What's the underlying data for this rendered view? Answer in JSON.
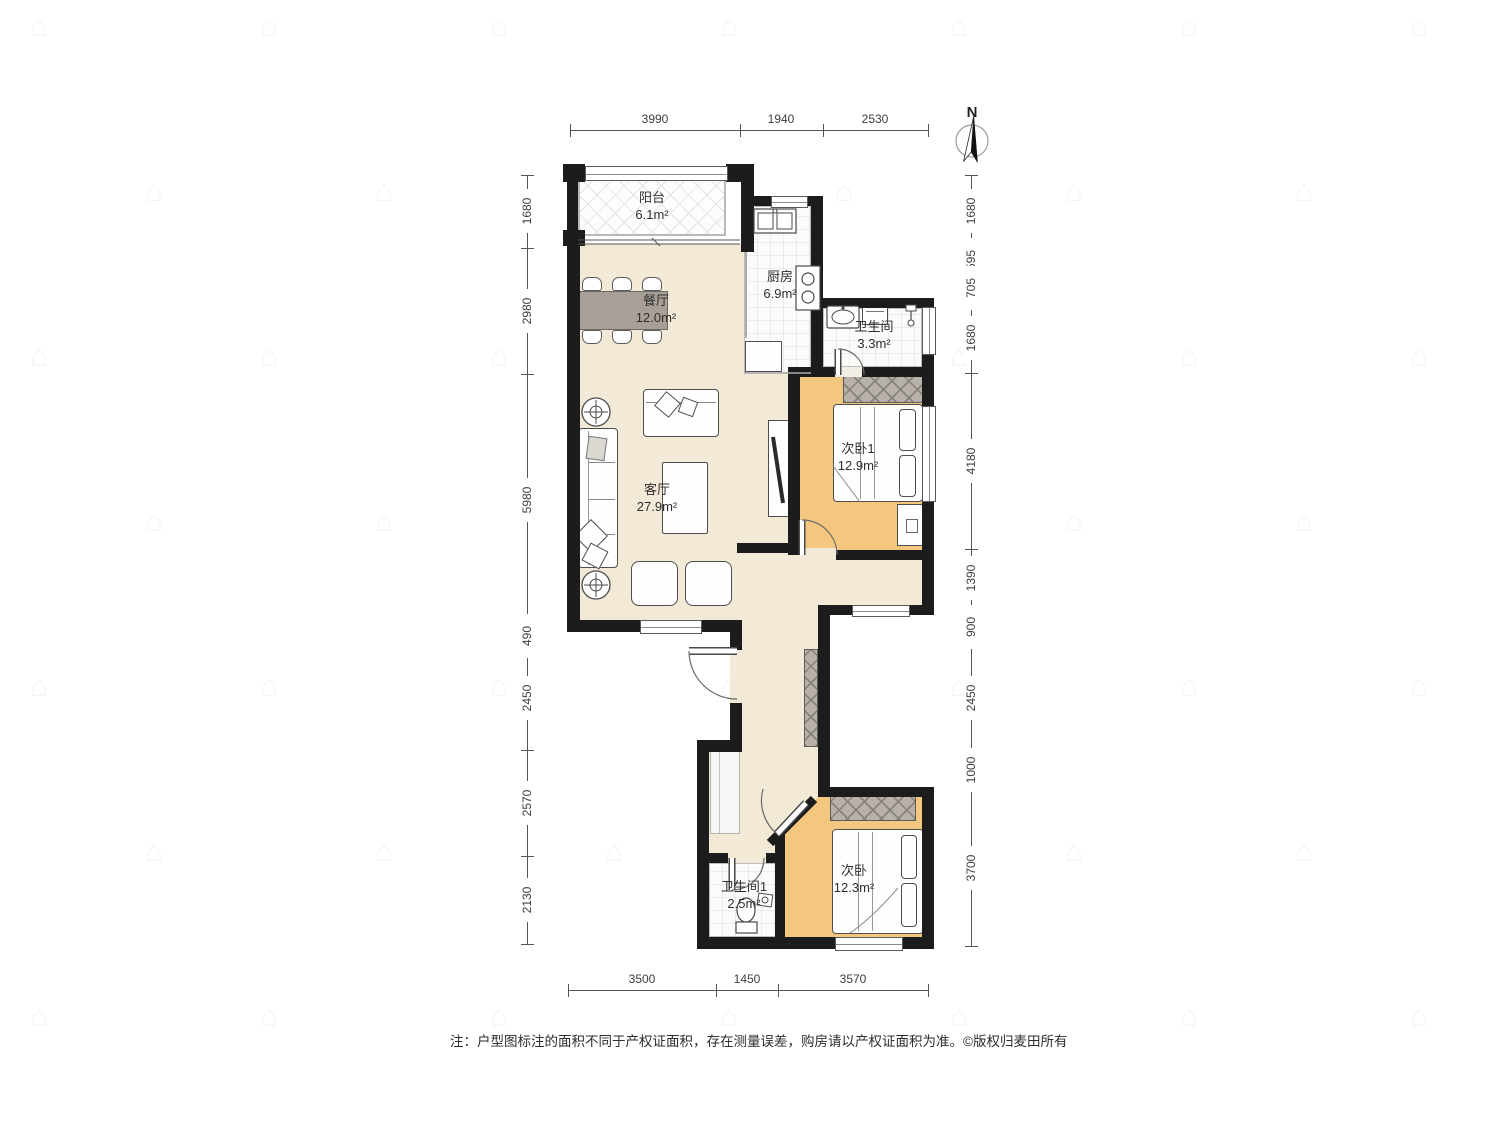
{
  "north_label": "N",
  "rooms": {
    "balcony": {
      "name": "阳台",
      "area": "6.1m²"
    },
    "kitchen": {
      "name": "厨房",
      "area": "6.9m²"
    },
    "bath": {
      "name": "卫生间",
      "area": "3.3m²"
    },
    "dining": {
      "name": "餐厅",
      "area": "12.0m²"
    },
    "living": {
      "name": "客厅",
      "area": "27.9m²"
    },
    "bedroom1": {
      "name": "次卧1",
      "area": "12.9m²"
    },
    "bath1": {
      "name": "卫生间1",
      "area": "2.5m²"
    },
    "bedroom2": {
      "name": "次卧",
      "area": "12.3m²"
    }
  },
  "dimensions": {
    "top": [
      "3990",
      "1940",
      "2530"
    ],
    "bottom": [
      "3500",
      "1450",
      "3570"
    ],
    "left": [
      "1680",
      "2980",
      "5980",
      "490",
      "2450",
      "2570",
      "2130"
    ],
    "right": [
      "1680",
      "595",
      "705",
      "1680",
      "4180",
      "1390",
      "900",
      "2450",
      "1000",
      "3700"
    ]
  },
  "note": {
    "text": "注：户型图标注的面积不同于产权证面积，存在测量误差，购房请以产权证面积为准。",
    "copyright": "©版权归麦田所有"
  },
  "colors": {
    "wall": "#1c1c1c",
    "floor_public": "#f2e9d6",
    "floor_bedroom": "#f4c781",
    "wardrobe_hatch": "#b7b1a9",
    "dining_table": "#a8a098"
  }
}
